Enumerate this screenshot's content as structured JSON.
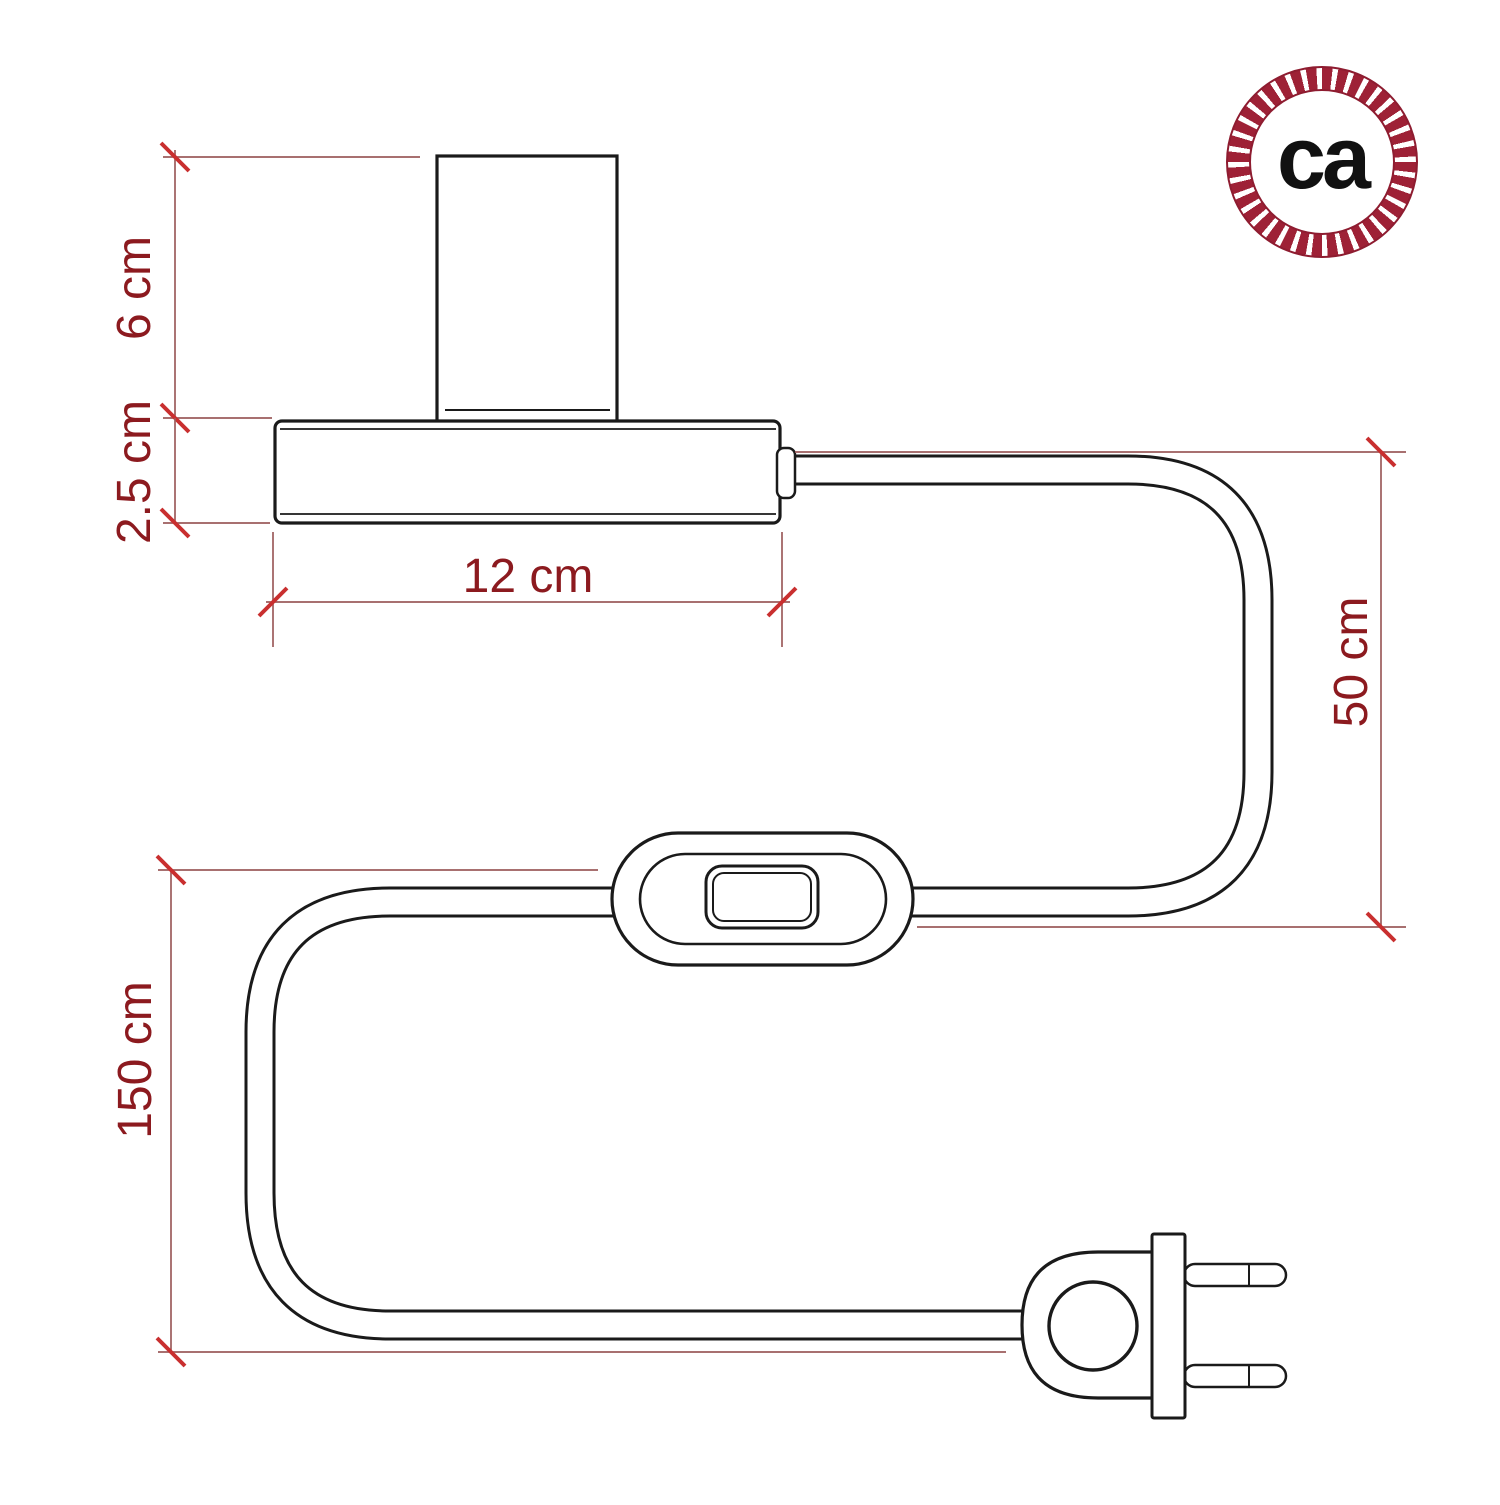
{
  "page": {
    "background": "#ffffff"
  },
  "brand_logo": {
    "text": "ca",
    "ring_color": "#9e2136",
    "text_color": "#111111",
    "ring_style": "rope-pattern-circle"
  },
  "drawing": {
    "stroke_color": "#1a1a1a",
    "parts": [
      "lamp-socket",
      "lamp-base",
      "cable-connector",
      "power-cable",
      "inline-switch",
      "two-prong-plug"
    ]
  },
  "annotations": {
    "text_color": "#8c1a1f",
    "line_color": "#9c5c5c",
    "tick_color": "#c92f2f",
    "socket_height": "6 cm",
    "base_thickness": "2.5 cm",
    "base_width": "12 cm",
    "cable_base_to_switch": "50 cm",
    "cable_switch_to_plug": "150 cm"
  }
}
